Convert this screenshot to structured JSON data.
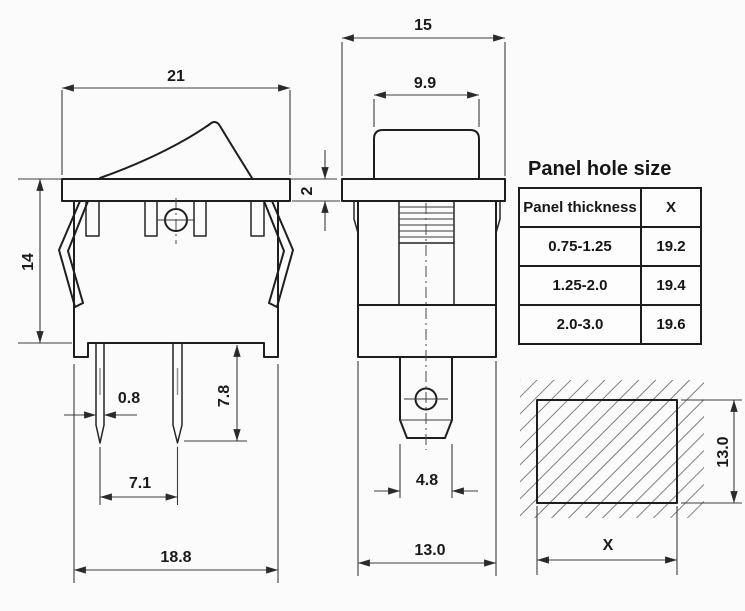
{
  "palette": {
    "background": "#fbfbfb",
    "line_color": "#1e1e1e",
    "dim_color": "#3c3c3c"
  },
  "side_view": {
    "dims": {
      "top_width": "21",
      "height": "14",
      "flange_thickness": "2",
      "pin_width": "0.8",
      "pin_length": "7.8",
      "pin_spacing": "7.1",
      "bottom_width": "18.8"
    }
  },
  "front_view": {
    "dims": {
      "top_width": "15",
      "rocker_width": "9.9",
      "terminal_width": "4.8",
      "bottom_width": "13.0"
    }
  },
  "cutout_view": {
    "dims": {
      "height": "13.0",
      "width": "X"
    }
  },
  "panel_table": {
    "title": "Panel hole size",
    "columns": [
      "Panel thickness",
      "X"
    ],
    "rows": [
      [
        "0.75-1.25",
        "19.2"
      ],
      [
        "1.25-2.0",
        "19.4"
      ],
      [
        "2.0-3.0",
        "19.6"
      ]
    ]
  }
}
